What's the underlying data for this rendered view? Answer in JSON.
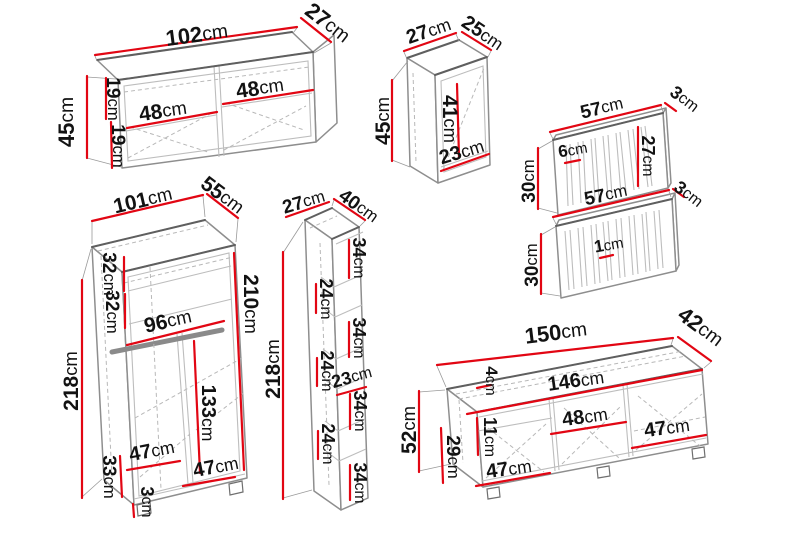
{
  "diagram": {
    "kind": "furniture-set-dimension-drawing",
    "unit": "cm",
    "colors": {
      "dimension_red": "#e20613",
      "outline_gray": "#8e8e8e",
      "hidden_edge_gray": "#b8b8b8",
      "label_black": "#121212",
      "background": "#ffffff"
    }
  },
  "pieces": {
    "wall_cabinet": {
      "width": "102cm",
      "depth": "27cm",
      "height": "45cm",
      "upper_shelf": "19cm",
      "lower_shelf": "19cm",
      "inner_left": "48cm",
      "inner_right": "48cm"
    },
    "small_cabinet": {
      "width": "27cm",
      "depth": "25cm",
      "height": "45cm",
      "inner_height": "41cm",
      "inner_width": "23cm"
    },
    "wall_panel_top": {
      "width": "57cm",
      "depth": "3cm",
      "height": "30cm",
      "slat_width": "6cm",
      "inner_height": "27cm"
    },
    "wall_panel_bottom": {
      "width": "57cm",
      "depth": "3cm",
      "height": "30cm",
      "slat_thickness": "1cm"
    },
    "wardrobe": {
      "width": "101cm",
      "depth": "55cm",
      "height": "218cm",
      "inner_height": "210cm",
      "upper_shelf": "32cm",
      "lower_shelf": "32cm",
      "rail_width": "96cm",
      "hanging_height": "133cm",
      "left_compartment": "47cm",
      "right_compartment": "47cm",
      "bottom_compartment": "33cm",
      "plinth": "3cm"
    },
    "tall_shelf": {
      "width": "27cm",
      "depth": "40cm",
      "height": "218cm",
      "inner_width": "23cm",
      "sections": [
        "34cm",
        "24cm",
        "34cm",
        "24cm",
        "34cm",
        "24cm",
        "34cm"
      ]
    },
    "tv_stand": {
      "width": "150cm",
      "depth": "42cm",
      "height": "52cm",
      "top_thickness": "4cm",
      "inner_width": "146cm",
      "drawer_height": "11cm",
      "inner_height": "29cm",
      "left_compartment": "47cm",
      "middle_compartment": "48cm",
      "right_compartment": "47cm"
    }
  }
}
